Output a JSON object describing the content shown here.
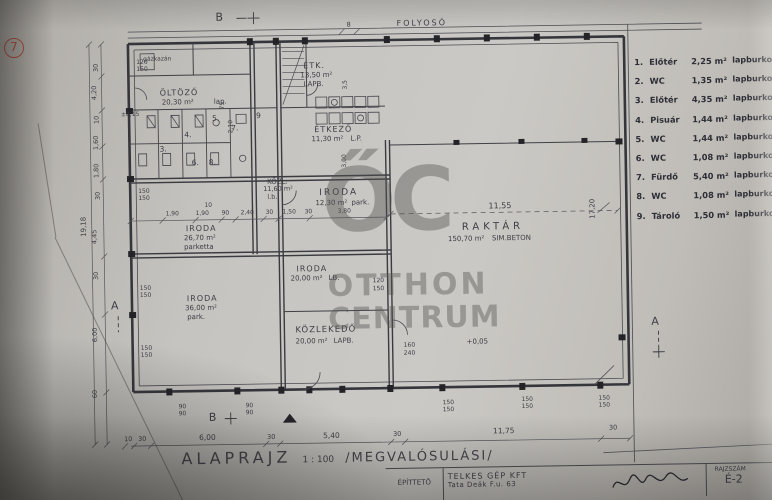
{
  "plan": {
    "title": "ALAPRAJZ",
    "scale": "1 : 100",
    "variant": "/MEGVALÓSULÁSI/",
    "corridor": "FOLYOSÓ",
    "marker_a": "A",
    "marker_b": "B",
    "sheet_no": "7"
  },
  "rooms": {
    "gazkazan": "gázkazán",
    "oltozo": {
      "name": "ÖLTÖZŐ",
      "area": "20,30 m²",
      "finish": "lap."
    },
    "etk": {
      "name": "ÉTK.",
      "area": "13,50 m²",
      "finish": "LAPB."
    },
    "etkezo": {
      "name": "ÉTKEZŐ",
      "area": "11,30 m²",
      "finish": "L.P."
    },
    "kozl": {
      "name": "KÖZL.",
      "area": "11,60 m²",
      "finish": "l.b."
    },
    "iroda1": {
      "name": "IRODA",
      "area": "12,30 m²",
      "finish": "park."
    },
    "iroda2": {
      "name": "IRODA",
      "area": "26,70 m²",
      "finish": "parketta"
    },
    "iroda3": {
      "name": "IRODA",
      "area": "20,00 m²",
      "finish": "LB."
    },
    "iroda4": {
      "name": "IRODA",
      "area": "36,00 m²",
      "finish": "park."
    },
    "kozlekedo": {
      "name": "KÖZLEKEDŐ",
      "area": "20,00 m²",
      "finish": "LAPB."
    },
    "raktar": {
      "name": "RAKTÁR",
      "area": "150,70 m²",
      "finish": "SIM.BETON"
    }
  },
  "room_numbers": [
    "3.",
    "4.",
    "5.",
    "6.",
    "7.",
    "8.",
    "9"
  ],
  "legend": {
    "items": [
      {
        "num": "1.",
        "name": "Előtér",
        "area": "2,25 m²",
        "finish": "lapburkolat"
      },
      {
        "num": "2.",
        "name": "WC",
        "area": "1,35 m²",
        "finish": "lapburkolat"
      },
      {
        "num": "3.",
        "name": "Előtér",
        "area": "4,35 m²",
        "finish": "lapburkolat"
      },
      {
        "num": "4.",
        "name": "Pisuár",
        "area": "1,44 m²",
        "finish": "lapburkolat"
      },
      {
        "num": "5.",
        "name": "WC",
        "area": "1,44 m²",
        "finish": "lapburkolat"
      },
      {
        "num": "6.",
        "name": "WC",
        "area": "1,08 m²",
        "finish": "lapburkolat"
      },
      {
        "num": "7.",
        "name": "Fürdő",
        "area": "5,40 m²",
        "finish": "lapburkolat"
      },
      {
        "num": "8.",
        "name": "WC",
        "area": "1,08 m²",
        "finish": "lapburkolat"
      },
      {
        "num": "9.",
        "name": "Tároló",
        "area": "1,50 m²",
        "finish": "lapburkolat"
      }
    ]
  },
  "dims": {
    "bottom": [
      "10",
      "30",
      "6,00",
      "30",
      "5,40",
      "30",
      "11,75",
      "30"
    ],
    "left": [
      "30",
      "4,20",
      "10",
      "1,60",
      "1,80",
      "30",
      "4,45",
      "30",
      "6,00",
      "60"
    ],
    "left_total": "19,18",
    "right_height": "17,20",
    "raktar_width": "11,55",
    "mid": [
      "1,90",
      "1,90",
      "90",
      "2,40",
      "30",
      "1,50",
      "30",
      "3,80"
    ]
  },
  "marks": {
    "level_raktar": "+0,05",
    "level_entry": "±0,15",
    "w120": "120",
    "w150": "150",
    "w160": "160",
    "w240": "240",
    "w90": "90",
    "d210": "2,10",
    "d75": "75",
    "d35": "3,5",
    "d300": "3,00",
    "d8": "8",
    "d10": "10"
  },
  "watermark": {
    "logo": "ŐC",
    "line1": "OTTHON",
    "line2": "CENTRUM"
  },
  "titleblock": {
    "client_label": "ÉPÍTTETŐ",
    "client_name": "TELKES GÉP KFT",
    "client_address": "Tata Deák F.u. 63",
    "number_label": "RAJZSZÁM",
    "number": "É-2"
  }
}
